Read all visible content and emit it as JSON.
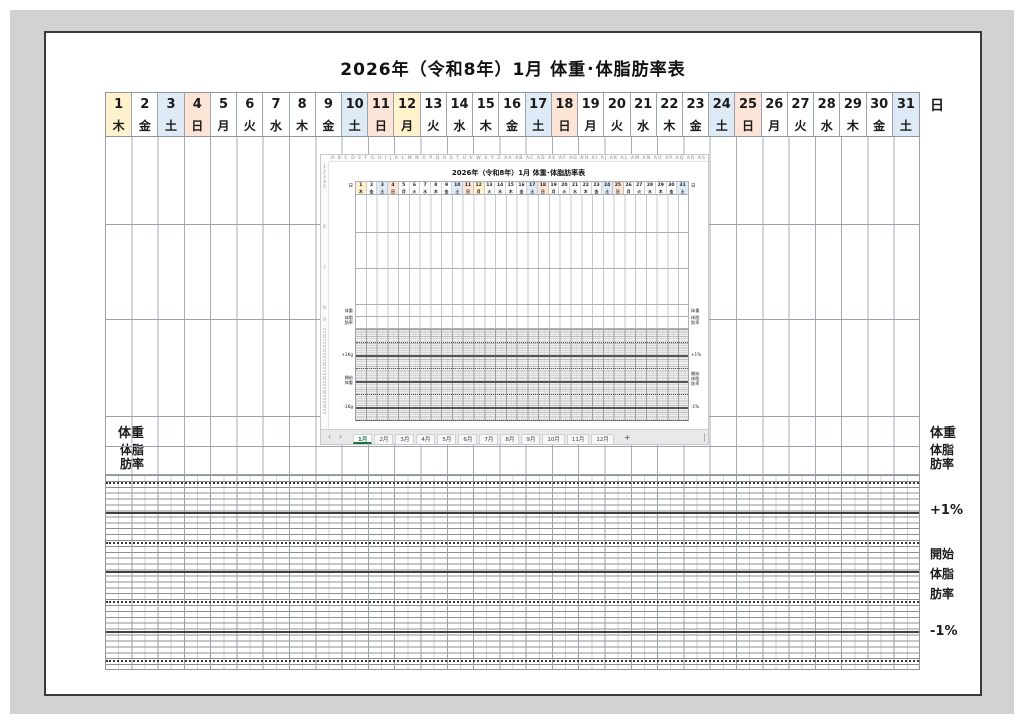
{
  "title": "2026年（令和8年）1月 体重･体脂肪率表",
  "axis": {
    "left": {
      "day": "日",
      "weight": "体重",
      "bodyfat": "体脂\n肪率",
      "plus": "+1Kg",
      "start": "開始\n体重",
      "minus": "-1Kg"
    },
    "right": {
      "day": "日",
      "weight": "体重",
      "bodyfat": "体脂\n肪率",
      "plus": "+1%",
      "start": "開始\n体脂\n肪率",
      "minus": "-1%"
    }
  },
  "calendar": {
    "days": [
      {
        "n": "1",
        "w": "木",
        "t": "hol"
      },
      {
        "n": "2",
        "w": "金",
        "t": "wd"
      },
      {
        "n": "3",
        "w": "土",
        "t": "sat"
      },
      {
        "n": "4",
        "w": "日",
        "t": "sun"
      },
      {
        "n": "5",
        "w": "月",
        "t": "wd"
      },
      {
        "n": "6",
        "w": "火",
        "t": "wd"
      },
      {
        "n": "7",
        "w": "水",
        "t": "wd"
      },
      {
        "n": "8",
        "w": "木",
        "t": "wd"
      },
      {
        "n": "9",
        "w": "金",
        "t": "wd"
      },
      {
        "n": "10",
        "w": "土",
        "t": "sat"
      },
      {
        "n": "11",
        "w": "日",
        "t": "sun"
      },
      {
        "n": "12",
        "w": "月",
        "t": "hol"
      },
      {
        "n": "13",
        "w": "火",
        "t": "wd"
      },
      {
        "n": "14",
        "w": "水",
        "t": "wd"
      },
      {
        "n": "15",
        "w": "木",
        "t": "wd"
      },
      {
        "n": "16",
        "w": "金",
        "t": "wd"
      },
      {
        "n": "17",
        "w": "土",
        "t": "sat"
      },
      {
        "n": "18",
        "w": "日",
        "t": "sun"
      },
      {
        "n": "19",
        "w": "月",
        "t": "wd"
      },
      {
        "n": "20",
        "w": "火",
        "t": "wd"
      },
      {
        "n": "21",
        "w": "水",
        "t": "wd"
      },
      {
        "n": "22",
        "w": "木",
        "t": "wd"
      },
      {
        "n": "23",
        "w": "金",
        "t": "wd"
      },
      {
        "n": "24",
        "w": "土",
        "t": "sat"
      },
      {
        "n": "25",
        "w": "日",
        "t": "sun"
      },
      {
        "n": "26",
        "w": "月",
        "t": "wd"
      },
      {
        "n": "27",
        "w": "火",
        "t": "wd"
      },
      {
        "n": "28",
        "w": "水",
        "t": "wd"
      },
      {
        "n": "29",
        "w": "木",
        "t": "wd"
      },
      {
        "n": "30",
        "w": "金",
        "t": "wd"
      },
      {
        "n": "31",
        "w": "土",
        "t": "sat"
      }
    ]
  },
  "colors": {
    "hol": "#FFF2CC",
    "sat": "#DEEBF7",
    "sun": "#FCE4D6",
    "wd": "#FFFFFF",
    "accent_green": "#217346"
  },
  "inset": {
    "sheet_title": "2026年（令和8年）1月 体重･体脂肪率表",
    "column_letters": "A B C D E F G H I J K L M N O P Q R S T U V W X Y Z AA AB AC AD AE AF AG AH AI AJ AK AL AM AN AO AP AQ AR AS AT AU AV AW AX AY AZ BA BB BC BD BE BF BG BH BI BJ BK BL BM BN",
    "row_numbers": [
      "1",
      "2",
      "3",
      "4",
      "5",
      "6",
      "7",
      "8",
      "9"
    ],
    "row_strip": "10\n11\n12\n13\n14\n15\n16\n17\n18\n19\n20\n21\n22\n23\n24\n25\n26\n27\n28\n29\n30\n31\n32\n33\n34\n35\n36\n37\n38\n39\n40",
    "tabs": {
      "nav_left": "‹",
      "nav_right": "›",
      "items": [
        "1月",
        "2月",
        "3月",
        "4月",
        "5月",
        "6月",
        "7月",
        "8月",
        "9月",
        "10月",
        "11月",
        "12月"
      ],
      "active": "1月",
      "add": "+"
    }
  }
}
